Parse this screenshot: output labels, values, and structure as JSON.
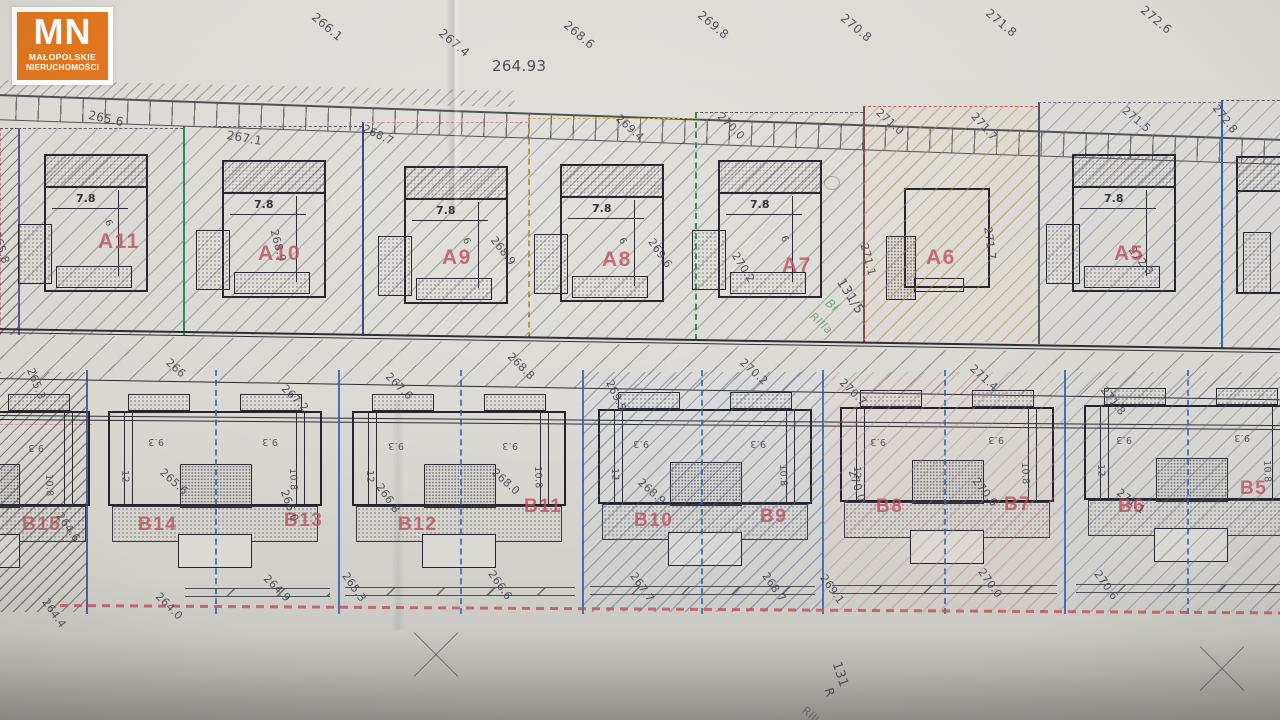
{
  "logo": {
    "initials": "MN",
    "line1": "MAŁOPOLSKIE",
    "line2": "NIERUCHOMOŚCI"
  },
  "colors": {
    "logo_orange": "#e0761f",
    "plot_label_red": "#bc4c60",
    "boundary_blue": "#2d62b2",
    "boundary_green": "#2f8a5b",
    "boundary_navy": "#45487c",
    "boundary_maroon": "#86454e",
    "hatch_orange": "#ba8a3e",
    "wavy_red": "#c4545e"
  },
  "top_edge_elevations": [
    "266.1",
    "267.4",
    "268.6",
    "269.8",
    "270.8",
    "271.8",
    "272.6"
  ],
  "fence_elevation": "264.93",
  "row_a": {
    "top_elevations": [
      "265.6",
      "267.1",
      "268.7",
      "269.4",
      "270.0",
      "271.0",
      "271.7",
      "271.5",
      "272.8"
    ],
    "side_elevations": [
      "265.8",
      "268.9",
      "268.9",
      "269.6",
      "270.2",
      "271.1",
      "271.7",
      "272.3"
    ],
    "plots": [
      {
        "label": "A11",
        "width_dim": "7.8",
        "depth_dim": "6"
      },
      {
        "label": "A10",
        "width_dim": "7.8"
      },
      {
        "label": "A9",
        "width_dim": "7.8",
        "depth_dim": "6"
      },
      {
        "label": "A8",
        "width_dim": "7.8",
        "depth_dim": "6"
      },
      {
        "label": "A7",
        "width_dim": "7.8",
        "depth_dim": "6"
      },
      {
        "label": "A6"
      },
      {
        "label": "A5",
        "width_dim": "7.8"
      }
    ],
    "parcel_annotation": "131/5",
    "soil_line1": "Bł",
    "soil_line2": "RIIIa"
  },
  "road_elevations": [
    "265.3",
    "266",
    "267.2",
    "267.6",
    "268.8",
    "269.5",
    "270.2",
    "270.7",
    "271.4",
    "271.8"
  ],
  "row_b": {
    "units": [
      {
        "label": "B15",
        "elev": "264.6"
      },
      {
        "label": "B14",
        "elev": "265.6"
      },
      {
        "label": "B13",
        "elev": "266.0"
      },
      {
        "label": "B12",
        "elev": "266.8"
      },
      {
        "label": "B11",
        "elev": "268.0"
      },
      {
        "label": "B10",
        "elev": "268.9"
      },
      {
        "label": "B9"
      },
      {
        "label": "B8",
        "elev": "270.0"
      },
      {
        "label": "B7",
        "elev": "270.6"
      },
      {
        "label": "B6",
        "elev": "271.1"
      },
      {
        "label": "B5"
      }
    ],
    "width_dim": "9.3",
    "depth_dim_outer": "10.8",
    "depth_dim_inner": "12"
  },
  "bottom_elevations": [
    "264.4",
    "264.0",
    "264.9",
    "265.3",
    "266.6",
    "267.7",
    "268.7",
    "269.1",
    "270.0",
    "270.6"
  ],
  "bottom_margin": {
    "parcel_number": "131",
    "land_class_1": "R",
    "land_class_2": "RIIIa"
  }
}
